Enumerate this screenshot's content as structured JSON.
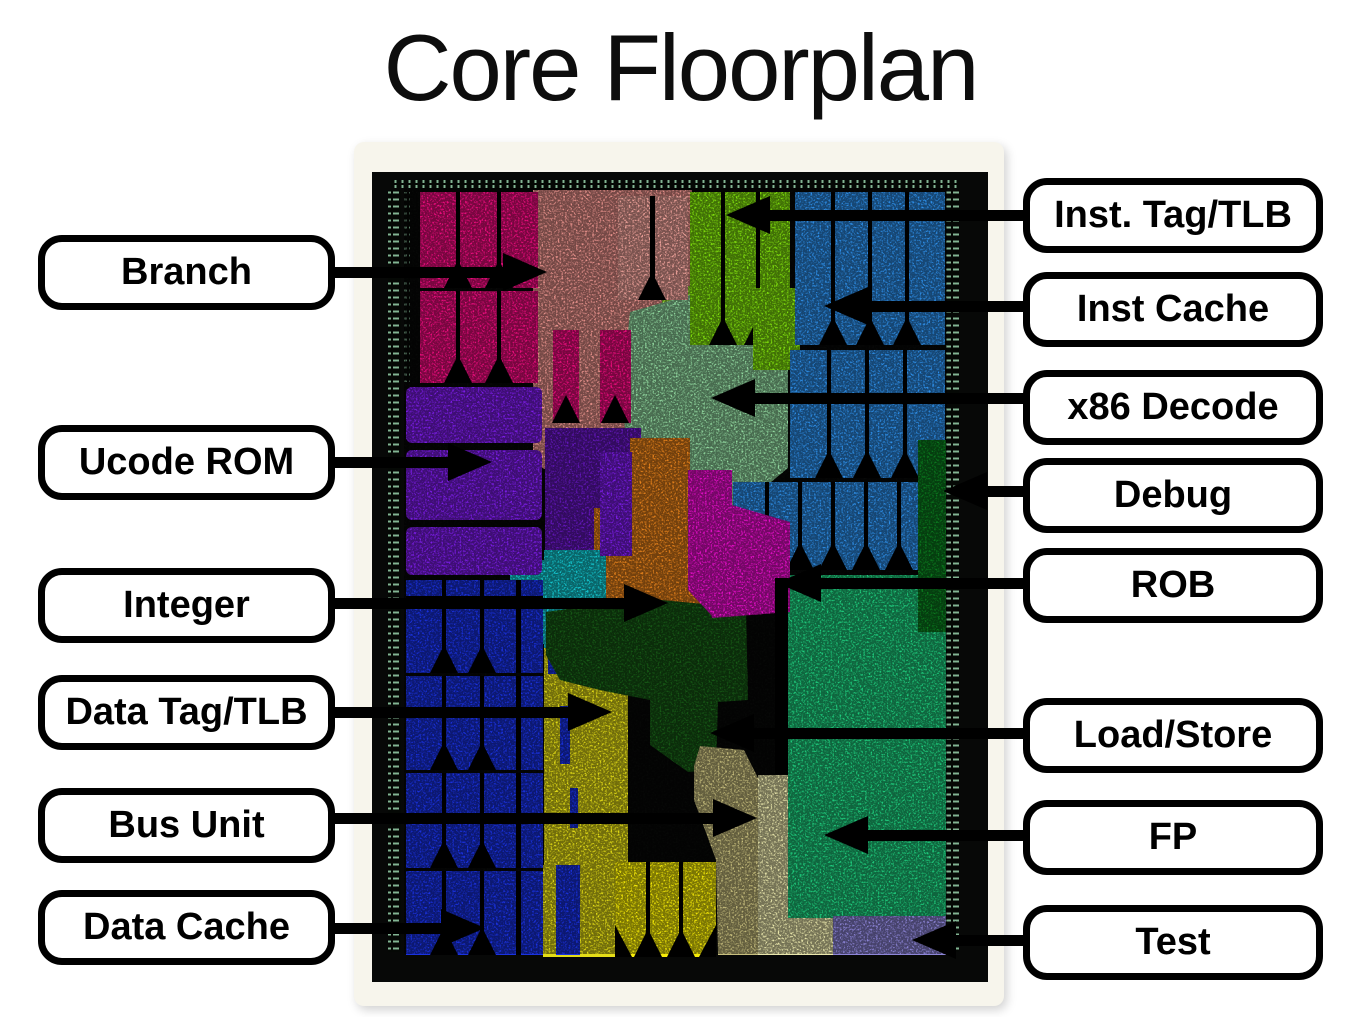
{
  "title": "Core Floorplan",
  "palette": {
    "page_bg": "#ffffff",
    "panel": "#f7f5ec",
    "title": "#0d0d0d",
    "label_bg": "#ffffff",
    "label_border": "#000000",
    "arrow": "#000000",
    "die_black": "#070807",
    "pad_line": "#98d4ac",
    "pink": "#f00d80",
    "salmon": "#ea938d",
    "salmon_block": "#f4a69e",
    "lime": "#82e20e",
    "lime_tex": "#9bdc35",
    "blue": "#2e8fe9",
    "mint": "#92d9a0",
    "purple": "#7d1de9",
    "purple_tex": "#6517be",
    "orange": "#e6821c",
    "magenta": "#e90fcc",
    "cyan": "#14cad3",
    "debug_green": "#0b7c1f",
    "dcache_blue": "#1a32e2",
    "yellow": "#e4dd17",
    "yellow_block": "#f7ec08",
    "ls_green": "#175a16",
    "khaki": "#c8bf7e",
    "pale": "#eae7ac",
    "fp_green": "#1fcc7d",
    "lavender": "#8e86d9"
  },
  "labels": {
    "left": [
      {
        "text": "Branch"
      },
      {
        "text": "Ucode ROM"
      },
      {
        "text": "Integer"
      },
      {
        "text": "Data Tag/TLB"
      },
      {
        "text": "Bus Unit"
      },
      {
        "text": "Data Cache"
      }
    ],
    "right": [
      {
        "text": "Inst. Tag/TLB"
      },
      {
        "text": "Inst Cache"
      },
      {
        "text": "x86 Decode"
      },
      {
        "text": "Debug"
      },
      {
        "text": "ROB"
      },
      {
        "text": "Load/Store"
      },
      {
        "text": "FP"
      },
      {
        "text": "Test"
      }
    ]
  },
  "regions": [
    {
      "name": "branch",
      "color": "pink"
    },
    {
      "name": "ucode-rom",
      "color": "purple"
    },
    {
      "name": "integer",
      "color": "orange"
    },
    {
      "name": "data-tag-tlb",
      "color": "yellow"
    },
    {
      "name": "bus-unit",
      "color": "khaki"
    },
    {
      "name": "data-cache",
      "color": "dcache_blue"
    },
    {
      "name": "inst-tag-tlb",
      "color": "lime"
    },
    {
      "name": "inst-cache",
      "color": "blue"
    },
    {
      "name": "x86-decode",
      "color": "mint"
    },
    {
      "name": "debug",
      "color": "debug_green"
    },
    {
      "name": "rob",
      "color": "magenta"
    },
    {
      "name": "load-store",
      "color": "ls_green"
    },
    {
      "name": "fp",
      "color": "fp_green"
    },
    {
      "name": "test",
      "color": "lavender"
    }
  ]
}
